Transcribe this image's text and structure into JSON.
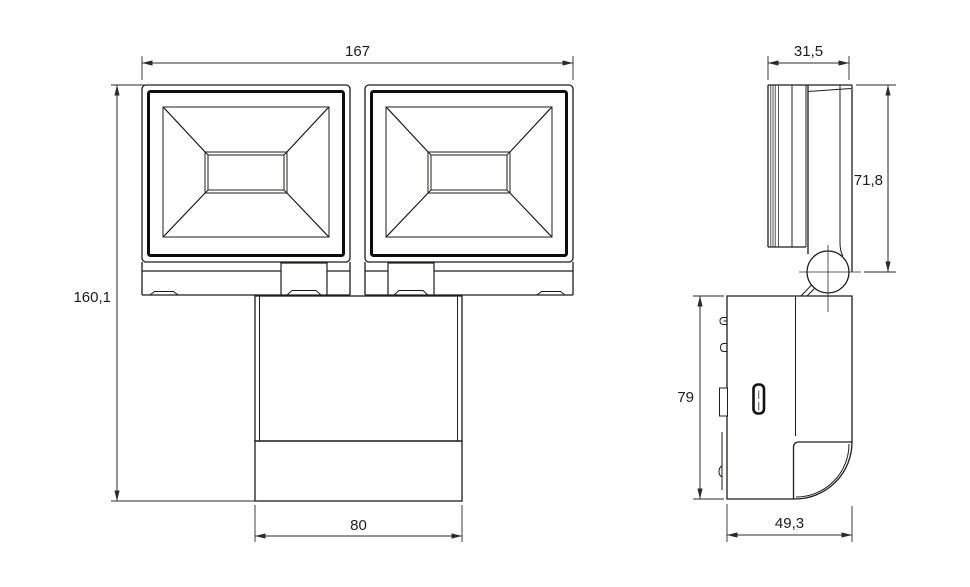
{
  "drawing": {
    "views": {
      "front": {
        "dimensions": {
          "width": "167",
          "height": "160,1",
          "base_width": "80"
        }
      },
      "side": {
        "dimensions": {
          "head_depth": "31,5",
          "head_height": "71,8",
          "body_height": "79",
          "body_depth": "49,3"
        }
      }
    },
    "colors": {
      "line": "#1d1d1b",
      "dimension_line": "#2b2b2b",
      "background": "#ffffff"
    }
  }
}
